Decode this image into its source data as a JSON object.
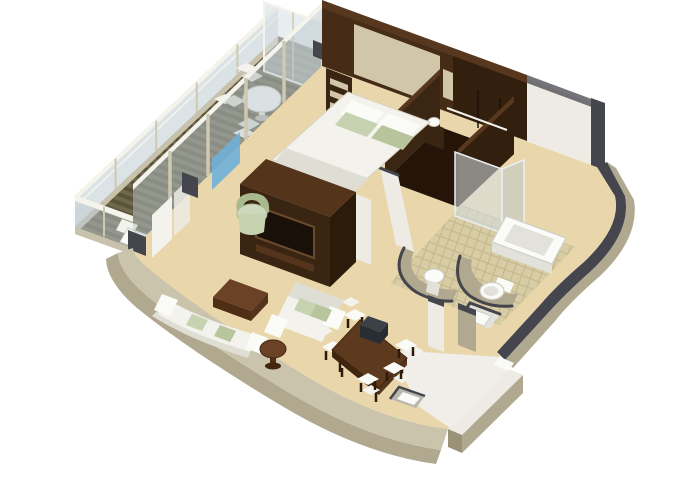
{
  "scene": {
    "title": "3D isometric cutaway floor plan of a suite",
    "rooms": [
      {
        "name": "balcony",
        "features": [
          "wood plank deck",
          "glass balustrade",
          "round table",
          "three chairs",
          "lounger"
        ]
      },
      {
        "name": "bedroom",
        "features": [
          "double bed",
          "green and white pillows",
          "headboard wall",
          "shelf niches",
          "bedside lamps",
          "nightstand"
        ]
      },
      {
        "name": "walk-in-closet",
        "features": [
          "dark wood wardrobe",
          "hanging rod"
        ]
      },
      {
        "name": "bathroom",
        "features": [
          "bathtub",
          "glass shower screen",
          "vanity sink",
          "toilet",
          "curved partitions",
          "tiled floor"
        ]
      },
      {
        "name": "living-room",
        "features": [
          "curved sofa",
          "two-seat sofa",
          "green tub chair",
          "ottoman coffee table",
          "round side table",
          "tv console divider"
        ]
      },
      {
        "name": "dining-area",
        "features": [
          "rectangular dining table",
          "six white chairs",
          "dark box on table"
        ]
      },
      {
        "name": "entry-hall",
        "features": [
          "white floor",
          "door mat"
        ]
      }
    ]
  },
  "palette": {
    "bg": "#ffffff",
    "deck_a": "#6f684b",
    "deck_b": "#5a533b",
    "deck_lip": "#c8c1ab",
    "glass": "#b9c8ce",
    "glass_light": "#d6dfe3",
    "glass_blue": "#6fb0d8",
    "rail": "#f4f3ec",
    "post": "#cfc8b2",
    "wall_top": "#cbc4ad",
    "wall_side": "#b1a890",
    "wall_side_dark": "#9a9179",
    "wall_white": "#edebe4",
    "cap_dark": "#45454d",
    "cap_brown": "#57381e",
    "carpet": "#e9d7ab",
    "tile": "#d8cca5",
    "tile_line": "#c2b58c",
    "wood_dark": "#3a2412",
    "wood_deep": "#2c1a0a",
    "wood_mid": "#54351c",
    "wood_brown": "#6b4226",
    "wood_brown_dark": "#4f2e16",
    "headboard_wall": "#462c17",
    "headboard_panel": "#d2c6a8",
    "closet_face": "#3b2513",
    "closet_floor": "#241508",
    "closet_side": "#331f0e",
    "furn_white": "#f3f2ec",
    "furn_shade": "#dfded5",
    "green": "#c6d2b0",
    "green_dark": "#b7c49c",
    "green_chair": "#cdd9bd",
    "green_chair_dark": "#a9ba8e",
    "fixture": "#fbfbf8",
    "fixture_shade": "#e3e2da",
    "fixture_line": "#cfcfc7",
    "tv_screen": "#191009",
    "tv_frame": "#6b4a2c",
    "box_dark": "#3c4148",
    "box_dark_side": "#282d34",
    "entry_floor": "#efeee9",
    "mat": "#fafaf8",
    "mat_border": "#b9b6ad",
    "table_wood": "#5d3a1e",
    "table_wood_dark": "#40250f",
    "leg": "#2e1a08"
  }
}
